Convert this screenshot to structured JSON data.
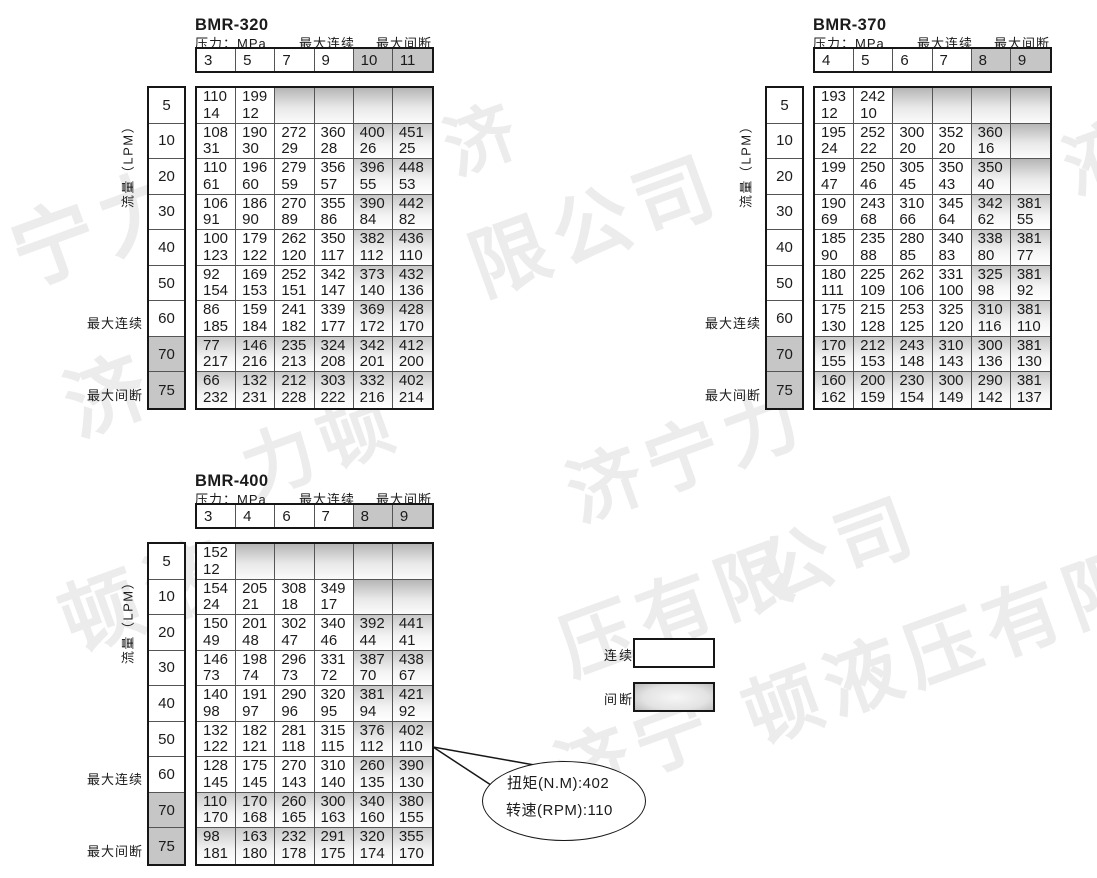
{
  "page": {
    "background": "#ffffff"
  },
  "colors": {
    "border_outer": "#161616",
    "border_inner": "#555555",
    "header_gray": "#c6c6c6",
    "shade_top": "#c9c9c9",
    "watermark": "#ececec"
  },
  "legend": {
    "continuous_label": "连续",
    "intermittent_label": "间断"
  },
  "callout": {
    "torque_line": "扭矩(N.M):402",
    "speed_line": "转速(RPM):110",
    "tail_lines": [
      [
        433,
        747,
        540,
        766
      ],
      [
        433,
        747,
        497,
        789
      ]
    ]
  },
  "watermarks": [
    {
      "text": "宁力",
      "x": -8,
      "y": 196,
      "size": 84
    },
    {
      "text": "济",
      "x": 428,
      "y": 100,
      "size": 70
    },
    {
      "text": "限公司",
      "x": 452,
      "y": 212,
      "size": 78
    },
    {
      "text": "济",
      "x": 850,
      "y": 190,
      "size": 82
    },
    {
      "text": "液",
      "x": 1046,
      "y": 116,
      "size": 72
    },
    {
      "text": "济",
      "x": 46,
      "y": 350,
      "size": 80
    },
    {
      "text": "力顿",
      "x": 225,
      "y": 418,
      "size": 72
    },
    {
      "text": "济宁力",
      "x": 550,
      "y": 442,
      "size": 74
    },
    {
      "text": "顿液",
      "x": 42,
      "y": 566,
      "size": 80
    },
    {
      "text": "压有限",
      "x": 542,
      "y": 596,
      "size": 74
    },
    {
      "text": "公司",
      "x": 740,
      "y": 522,
      "size": 74
    },
    {
      "text": "济宁",
      "x": 538,
      "y": 722,
      "size": 74
    },
    {
      "text": "顿液压有限",
      "x": 726,
      "y": 662,
      "size": 76
    }
  ],
  "tables": [
    {
      "title": "BMR-320",
      "pressure_unit_label": "压力：MPa",
      "continuous_header_label": "最大连续",
      "intermittent_header_label": "最大间断",
      "flow_axis_label": "流量（LPM）",
      "continuous_row_label": "最大连续",
      "intermittent_row_label": "最大间断",
      "pressures": [
        "3",
        "5",
        "7",
        "9",
        "10",
        "11"
      ],
      "flows": [
        "5",
        "10",
        "20",
        "30",
        "40",
        "50",
        "60",
        "70",
        "75"
      ],
      "intermittent_col_start": 4,
      "intermittent_row_start": 7,
      "rows": [
        [
          [
            110,
            14
          ],
          [
            199,
            12
          ],
          null,
          null,
          null,
          null
        ],
        [
          [
            108,
            31
          ],
          [
            190,
            30
          ],
          [
            272,
            29
          ],
          [
            360,
            28
          ],
          [
            400,
            26
          ],
          [
            451,
            25
          ]
        ],
        [
          [
            110,
            61
          ],
          [
            196,
            60
          ],
          [
            279,
            59
          ],
          [
            356,
            57
          ],
          [
            396,
            55
          ],
          [
            448,
            53
          ]
        ],
        [
          [
            106,
            91
          ],
          [
            186,
            90
          ],
          [
            270,
            89
          ],
          [
            355,
            86
          ],
          [
            390,
            84
          ],
          [
            442,
            82
          ]
        ],
        [
          [
            100,
            123
          ],
          [
            179,
            122
          ],
          [
            262,
            120
          ],
          [
            350,
            117
          ],
          [
            382,
            112
          ],
          [
            436,
            110
          ]
        ],
        [
          [
            92,
            154
          ],
          [
            169,
            153
          ],
          [
            252,
            151
          ],
          [
            342,
            147
          ],
          [
            373,
            140
          ],
          [
            432,
            136
          ]
        ],
        [
          [
            86,
            185
          ],
          [
            159,
            184
          ],
          [
            241,
            182
          ],
          [
            339,
            177
          ],
          [
            369,
            172
          ],
          [
            428,
            170
          ]
        ],
        [
          [
            77,
            217
          ],
          [
            146,
            216
          ],
          [
            235,
            213
          ],
          [
            324,
            208
          ],
          [
            342,
            201
          ],
          [
            412,
            200
          ]
        ],
        [
          [
            66,
            232
          ],
          [
            132,
            231
          ],
          [
            212,
            228
          ],
          [
            303,
            222
          ],
          [
            332,
            216
          ],
          [
            402,
            214
          ]
        ]
      ]
    },
    {
      "title": "BMR-370",
      "pressure_unit_label": "压力：MPa",
      "continuous_header_label": "最大连续",
      "intermittent_header_label": "最大间断",
      "flow_axis_label": "流量（LPM）",
      "continuous_row_label": "最大连续",
      "intermittent_row_label": "最大间断",
      "pressures": [
        "4",
        "5",
        "6",
        "7",
        "8",
        "9"
      ],
      "flows": [
        "5",
        "10",
        "20",
        "30",
        "40",
        "50",
        "60",
        "70",
        "75"
      ],
      "intermittent_col_start": 4,
      "intermittent_row_start": 7,
      "rows": [
        [
          [
            193,
            12
          ],
          [
            242,
            10
          ],
          null,
          null,
          null,
          null
        ],
        [
          [
            195,
            24
          ],
          [
            252,
            22
          ],
          [
            300,
            20
          ],
          [
            352,
            20
          ],
          [
            360,
            16
          ],
          null
        ],
        [
          [
            199,
            47
          ],
          [
            250,
            46
          ],
          [
            305,
            45
          ],
          [
            350,
            43
          ],
          [
            350,
            40
          ],
          null
        ],
        [
          [
            190,
            69
          ],
          [
            243,
            68
          ],
          [
            310,
            66
          ],
          [
            345,
            64
          ],
          [
            342,
            62
          ],
          [
            381,
            55
          ]
        ],
        [
          [
            185,
            90
          ],
          [
            235,
            88
          ],
          [
            280,
            85
          ],
          [
            340,
            83
          ],
          [
            338,
            80
          ],
          [
            381,
            77
          ]
        ],
        [
          [
            180,
            111
          ],
          [
            225,
            109
          ],
          [
            262,
            106
          ],
          [
            331,
            100
          ],
          [
            325,
            98
          ],
          [
            381,
            92
          ]
        ],
        [
          [
            175,
            130
          ],
          [
            215,
            128
          ],
          [
            253,
            125
          ],
          [
            325,
            120
          ],
          [
            310,
            116
          ],
          [
            381,
            110
          ]
        ],
        [
          [
            170,
            155
          ],
          [
            212,
            153
          ],
          [
            243,
            148
          ],
          [
            310,
            143
          ],
          [
            300,
            136
          ],
          [
            381,
            130
          ]
        ],
        [
          [
            160,
            162
          ],
          [
            200,
            159
          ],
          [
            230,
            154
          ],
          [
            300,
            149
          ],
          [
            290,
            142
          ],
          [
            381,
            137
          ]
        ]
      ]
    },
    {
      "title": "BMR-400",
      "pressure_unit_label": "压力：MPa",
      "continuous_header_label": "最大连续",
      "intermittent_header_label": "最大间断",
      "flow_axis_label": "流量（LPM）",
      "continuous_row_label": "最大连续",
      "intermittent_row_label": "最大间断",
      "pressures": [
        "3",
        "4",
        "6",
        "7",
        "8",
        "9"
      ],
      "flows": [
        "5",
        "10",
        "20",
        "30",
        "40",
        "50",
        "60",
        "70",
        "75"
      ],
      "intermittent_col_start": 4,
      "intermittent_row_start": 7,
      "rows": [
        [
          [
            152,
            12
          ],
          null,
          null,
          null,
          null,
          null
        ],
        [
          [
            154,
            24
          ],
          [
            205,
            21
          ],
          [
            308,
            18
          ],
          [
            349,
            17
          ],
          null,
          null
        ],
        [
          [
            150,
            49
          ],
          [
            201,
            48
          ],
          [
            302,
            47
          ],
          [
            340,
            46
          ],
          [
            392,
            44
          ],
          [
            441,
            41
          ]
        ],
        [
          [
            146,
            73
          ],
          [
            198,
            74
          ],
          [
            296,
            73
          ],
          [
            331,
            72
          ],
          [
            387,
            70
          ],
          [
            438,
            67
          ]
        ],
        [
          [
            140,
            98
          ],
          [
            191,
            97
          ],
          [
            290,
            96
          ],
          [
            320,
            95
          ],
          [
            381,
            94
          ],
          [
            421,
            92
          ]
        ],
        [
          [
            132,
            122
          ],
          [
            182,
            121
          ],
          [
            281,
            118
          ],
          [
            315,
            115
          ],
          [
            376,
            112
          ],
          [
            402,
            110
          ]
        ],
        [
          [
            128,
            145
          ],
          [
            175,
            145
          ],
          [
            270,
            143
          ],
          [
            310,
            140
          ],
          [
            260,
            135
          ],
          [
            390,
            130
          ]
        ],
        [
          [
            110,
            170
          ],
          [
            170,
            168
          ],
          [
            260,
            165
          ],
          [
            300,
            163
          ],
          [
            340,
            160
          ],
          [
            380,
            155
          ]
        ],
        [
          [
            98,
            181
          ],
          [
            163,
            180
          ],
          [
            232,
            178
          ],
          [
            291,
            175
          ],
          [
            320,
            174
          ],
          [
            355,
            170
          ]
        ]
      ]
    }
  ]
}
